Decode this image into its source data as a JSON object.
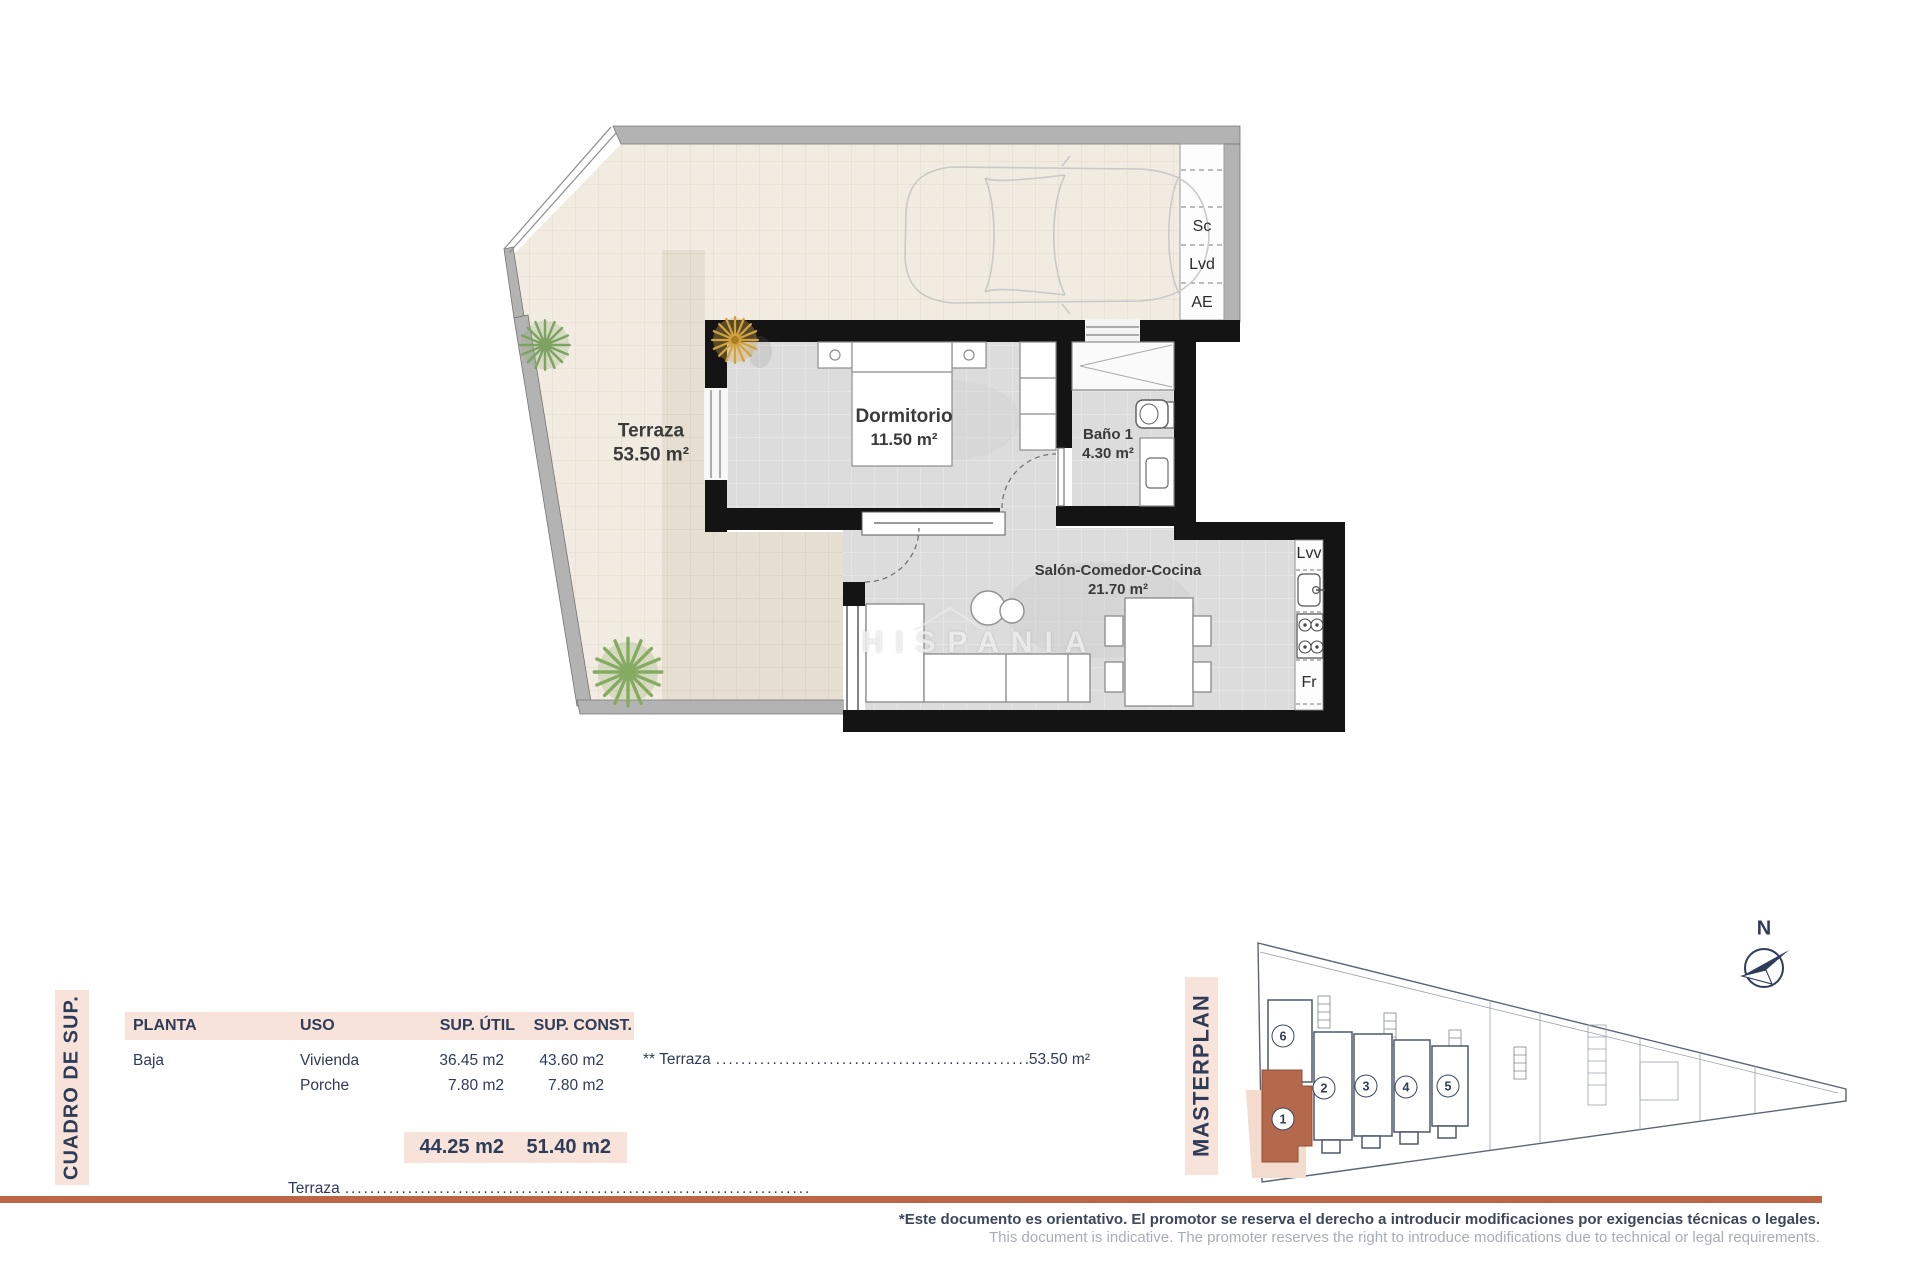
{
  "colors": {
    "accent_terracotta": "#bb6747",
    "unit_highlight": "#b5694c",
    "pink_band": "#f8e3da",
    "navy_text": "#2e3c59",
    "wall_black": "#141414",
    "wall_gray": "#b3b3b3",
    "terrace_beige": "#f1ebe1",
    "floor_gray": "#dcdcdc"
  },
  "floorplan": {
    "watermark": "HISPANIA",
    "rooms": [
      {
        "name": "Terraza",
        "area": "53.50 m²"
      },
      {
        "name": "Dormitorio",
        "area": "11.50 m²"
      },
      {
        "name": "Baño 1",
        "area": "4.30 m²"
      },
      {
        "name": "Salón-Comedor-Cocina",
        "area": "21.70 m²"
      }
    ],
    "labels": {
      "sc": "Sc",
      "lvd": "Lvd",
      "ae": "AE",
      "lvv": "Lvv",
      "fr": "Fr"
    }
  },
  "area_table": {
    "sidebar_title": "CUADRO DE SUP.",
    "headers": {
      "planta": "PLANTA",
      "uso": "USO",
      "util": "SUP. ÚTIL",
      "const": "SUP. CONST."
    },
    "rows": [
      {
        "planta": "Baja",
        "uso": "Vivienda",
        "util": "36.45 m2",
        "const": "43.60 m2"
      },
      {
        "planta": "",
        "uso": "Porche",
        "util": "7.80 m2",
        "const": "7.80 m2"
      }
    ],
    "totals": {
      "util": "44.25 m2",
      "const": "51.40 m2"
    },
    "terraza_note": {
      "label": "** Terraza",
      "dots": "..........................................................................................................",
      "value": "53.50 m²"
    },
    "bottom_row": {
      "label": "Terraza",
      "dots": ".........................................................................................."
    }
  },
  "masterplan": {
    "sidebar_title": "MASTERPLAN",
    "compass_label": "N",
    "units": {
      "u1": "1",
      "u2": "2",
      "u3": "3",
      "u4": "4",
      "u5": "5",
      "u6": "6"
    }
  },
  "footer": {
    "disclaimer_es": "*Este documento es orientativo. El promotor se reserva el derecho a introducir modificaciones por exigencias técnicas o legales.",
    "disclaimer_en": "This document is indicative. The promoter reserves the right to introduce modifications due to technical or legal requirements."
  }
}
